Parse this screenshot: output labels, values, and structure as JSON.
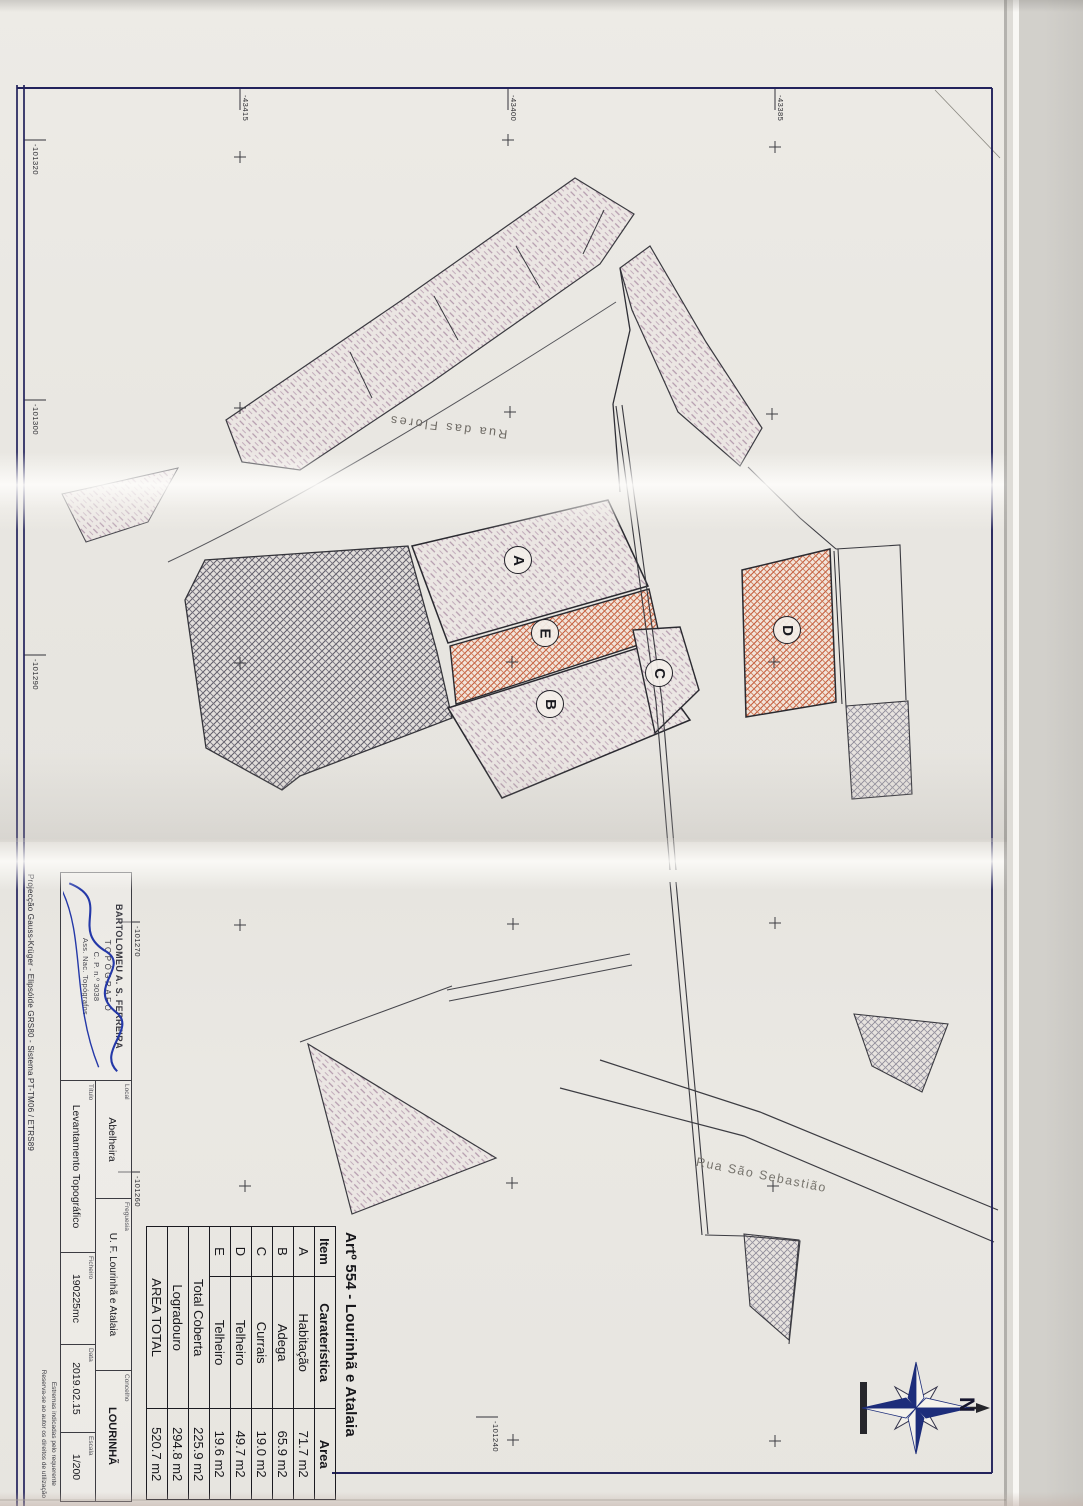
{
  "document": {
    "type": "Levantamento topográfico (scanned survey plan)",
    "title_art": "Artº 554 - Lourinhã e Atalaia"
  },
  "areas_table": {
    "headers": [
      "Item",
      "Caraterística",
      "Area"
    ],
    "rows": [
      {
        "item": "A",
        "caracteristica": "Habitação",
        "area": "71.7 m2"
      },
      {
        "item": "B",
        "caracteristica": "Adega",
        "area": "65.9 m2"
      },
      {
        "item": "C",
        "caracteristica": "Currais",
        "area": "19.0 m2"
      },
      {
        "item": "D",
        "caracteristica": "Telheiro",
        "area": "49.7 m2"
      },
      {
        "item": "E",
        "caracteristica": "Telheiro",
        "area": "19.6 m2"
      }
    ],
    "totals": [
      {
        "label": "Total Coberta",
        "area": "225.9 m2"
      },
      {
        "label": "Logradouro",
        "area": "294.8 m2"
      },
      {
        "label": "AREA TOTAL",
        "area": "520.7 m2"
      }
    ]
  },
  "title_block": {
    "stamp": {
      "line1": "BARTOLOMEU A. S. FERREIRA",
      "line2": "TOPÓGRAFO",
      "line3": "C. P. n.º 3038",
      "line4": "Ass. Nac. Topógrafos"
    },
    "fields": [
      {
        "label": "Local",
        "value": "Abelheira"
      },
      {
        "label": "Freguesia",
        "value": "U. F. Lourinhã e Atalaia"
      },
      {
        "label": "Concelho",
        "value": "LOURINHÃ"
      },
      {
        "label": "Título",
        "value": "Levantamento Topográfico"
      },
      {
        "label": "Ficheiro",
        "value": "190225mc"
      },
      {
        "label": "Data",
        "value": "2019.02.15"
      },
      {
        "label": "Escala",
        "value": "1/200"
      }
    ],
    "notes": [
      "Estremas indicadas pelo requerente",
      "Reserva-se ao autor os direitos de utilização"
    ],
    "projection": "Projecção Gauss-Krüger - Elipsóide GRS80 - Sistema PT-TM06 / ETRS89"
  },
  "map": {
    "streets": [
      "Rua das Flores",
      "Rua São Sebastião"
    ],
    "buildings": [
      "A",
      "E",
      "B",
      "C",
      "D"
    ],
    "coord_labels_left": [
      "-101320",
      "-101300",
      "-101290",
      "-101270",
      "-101260",
      "-101240"
    ],
    "coord_labels_top": [
      "-43415",
      "-43400",
      "-43385"
    ],
    "north_label": "N"
  },
  "colors": {
    "paper": "#e9e7e2",
    "frame_navy": "#23235c",
    "hatch_orange": "#c4593b",
    "hatch_grey": "#5f5c68",
    "hatch_light": "#b49bad",
    "signature_blue": "#2438a8",
    "compass_navy": "#1d2d7a"
  }
}
